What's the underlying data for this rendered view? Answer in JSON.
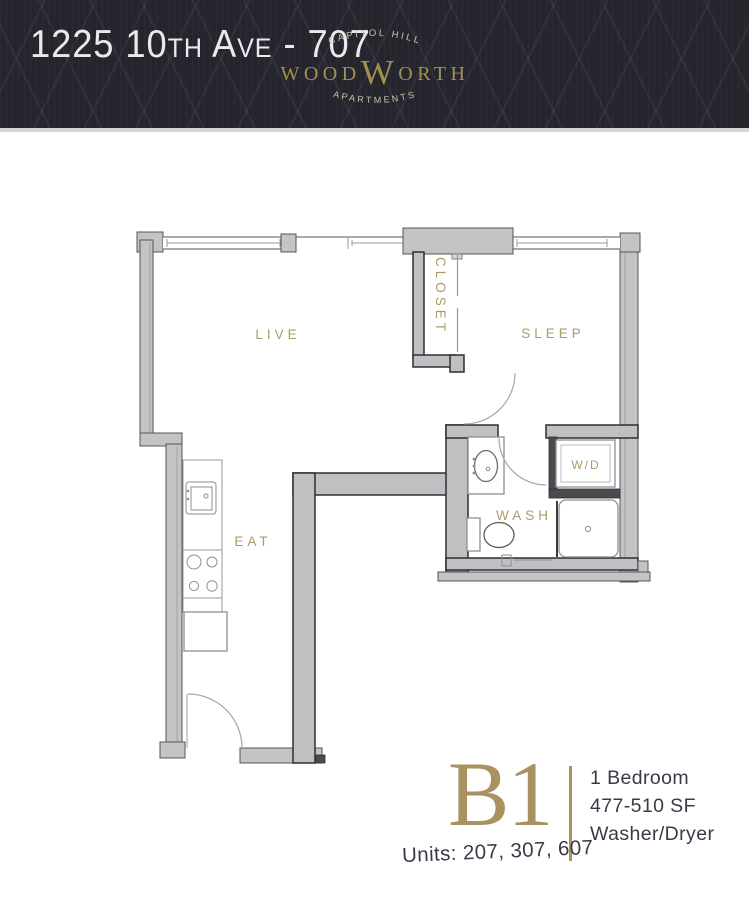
{
  "header": {
    "title": "1225 10th Ave - 707",
    "logo": {
      "top_arc": "CAPITOL HILL",
      "name_left": "WOOD",
      "name_big": "W",
      "name_right": "ORTH",
      "bottom_arc": "APARTMENTS"
    }
  },
  "plan": {
    "labels": {
      "live": "LIVE",
      "sleep": "SLEEP",
      "closet": "CLOSET",
      "eat": "EAT",
      "wash": "WASH",
      "wd": "W/D"
    }
  },
  "footer": {
    "plan_code": "B1",
    "details": [
      "1 Bedroom",
      "477-510 SF",
      "Washer/Dryer"
    ],
    "units": "Units: 207, 307, 607"
  },
  "colors": {
    "header_bg": "#25252e",
    "logo_gold": "#a3914f",
    "logo_cream": "#cdc3a8",
    "label_gold": "#ab9c66",
    "plan_code_gold": "#aa9160",
    "text_dark": "#3a3a47"
  }
}
